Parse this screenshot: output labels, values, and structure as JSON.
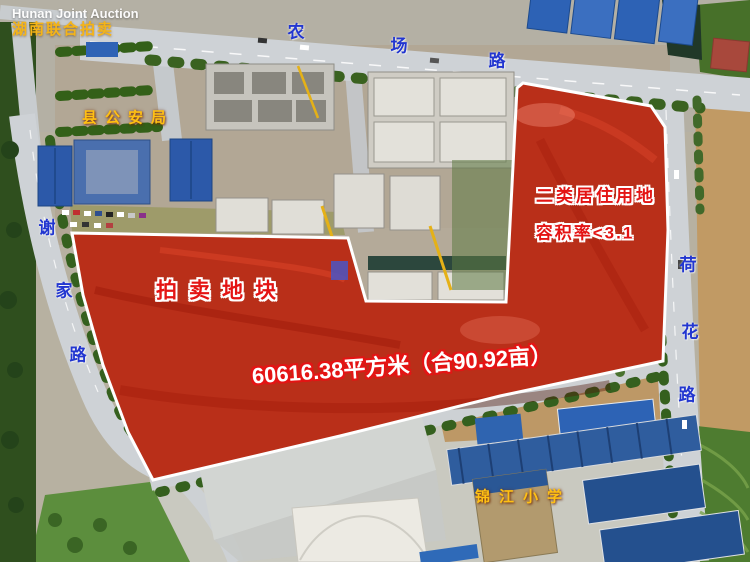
{
  "watermark": {
    "line1": "Hunan Joint Auction",
    "line2": "湖南联合拍卖"
  },
  "parcel": {
    "title": "拍卖地块",
    "zoning": "二类居住用地",
    "plot_ratio": "容积率<3.1",
    "area": "60616.38平方米（合90.92亩）"
  },
  "roads": [
    {
      "name": "农场路",
      "chars": [
        "农",
        "场",
        "路"
      ]
    },
    {
      "name": "谢家路",
      "chars": [
        "谢",
        "家",
        "路"
      ]
    },
    {
      "name": "荷花路",
      "chars": [
        "荷",
        "花",
        "路"
      ]
    }
  ],
  "landmarks": [
    {
      "name": "县公安局"
    },
    {
      "name": "锦江小学"
    }
  ],
  "colors": {
    "parcel_overlay": "#e41c0a",
    "boundary": "#ffffff",
    "road_label": "#2236d0",
    "landmark_label": "#ffc013",
    "annotation_red": "#e41414",
    "annotation_white": "#ffffff"
  }
}
